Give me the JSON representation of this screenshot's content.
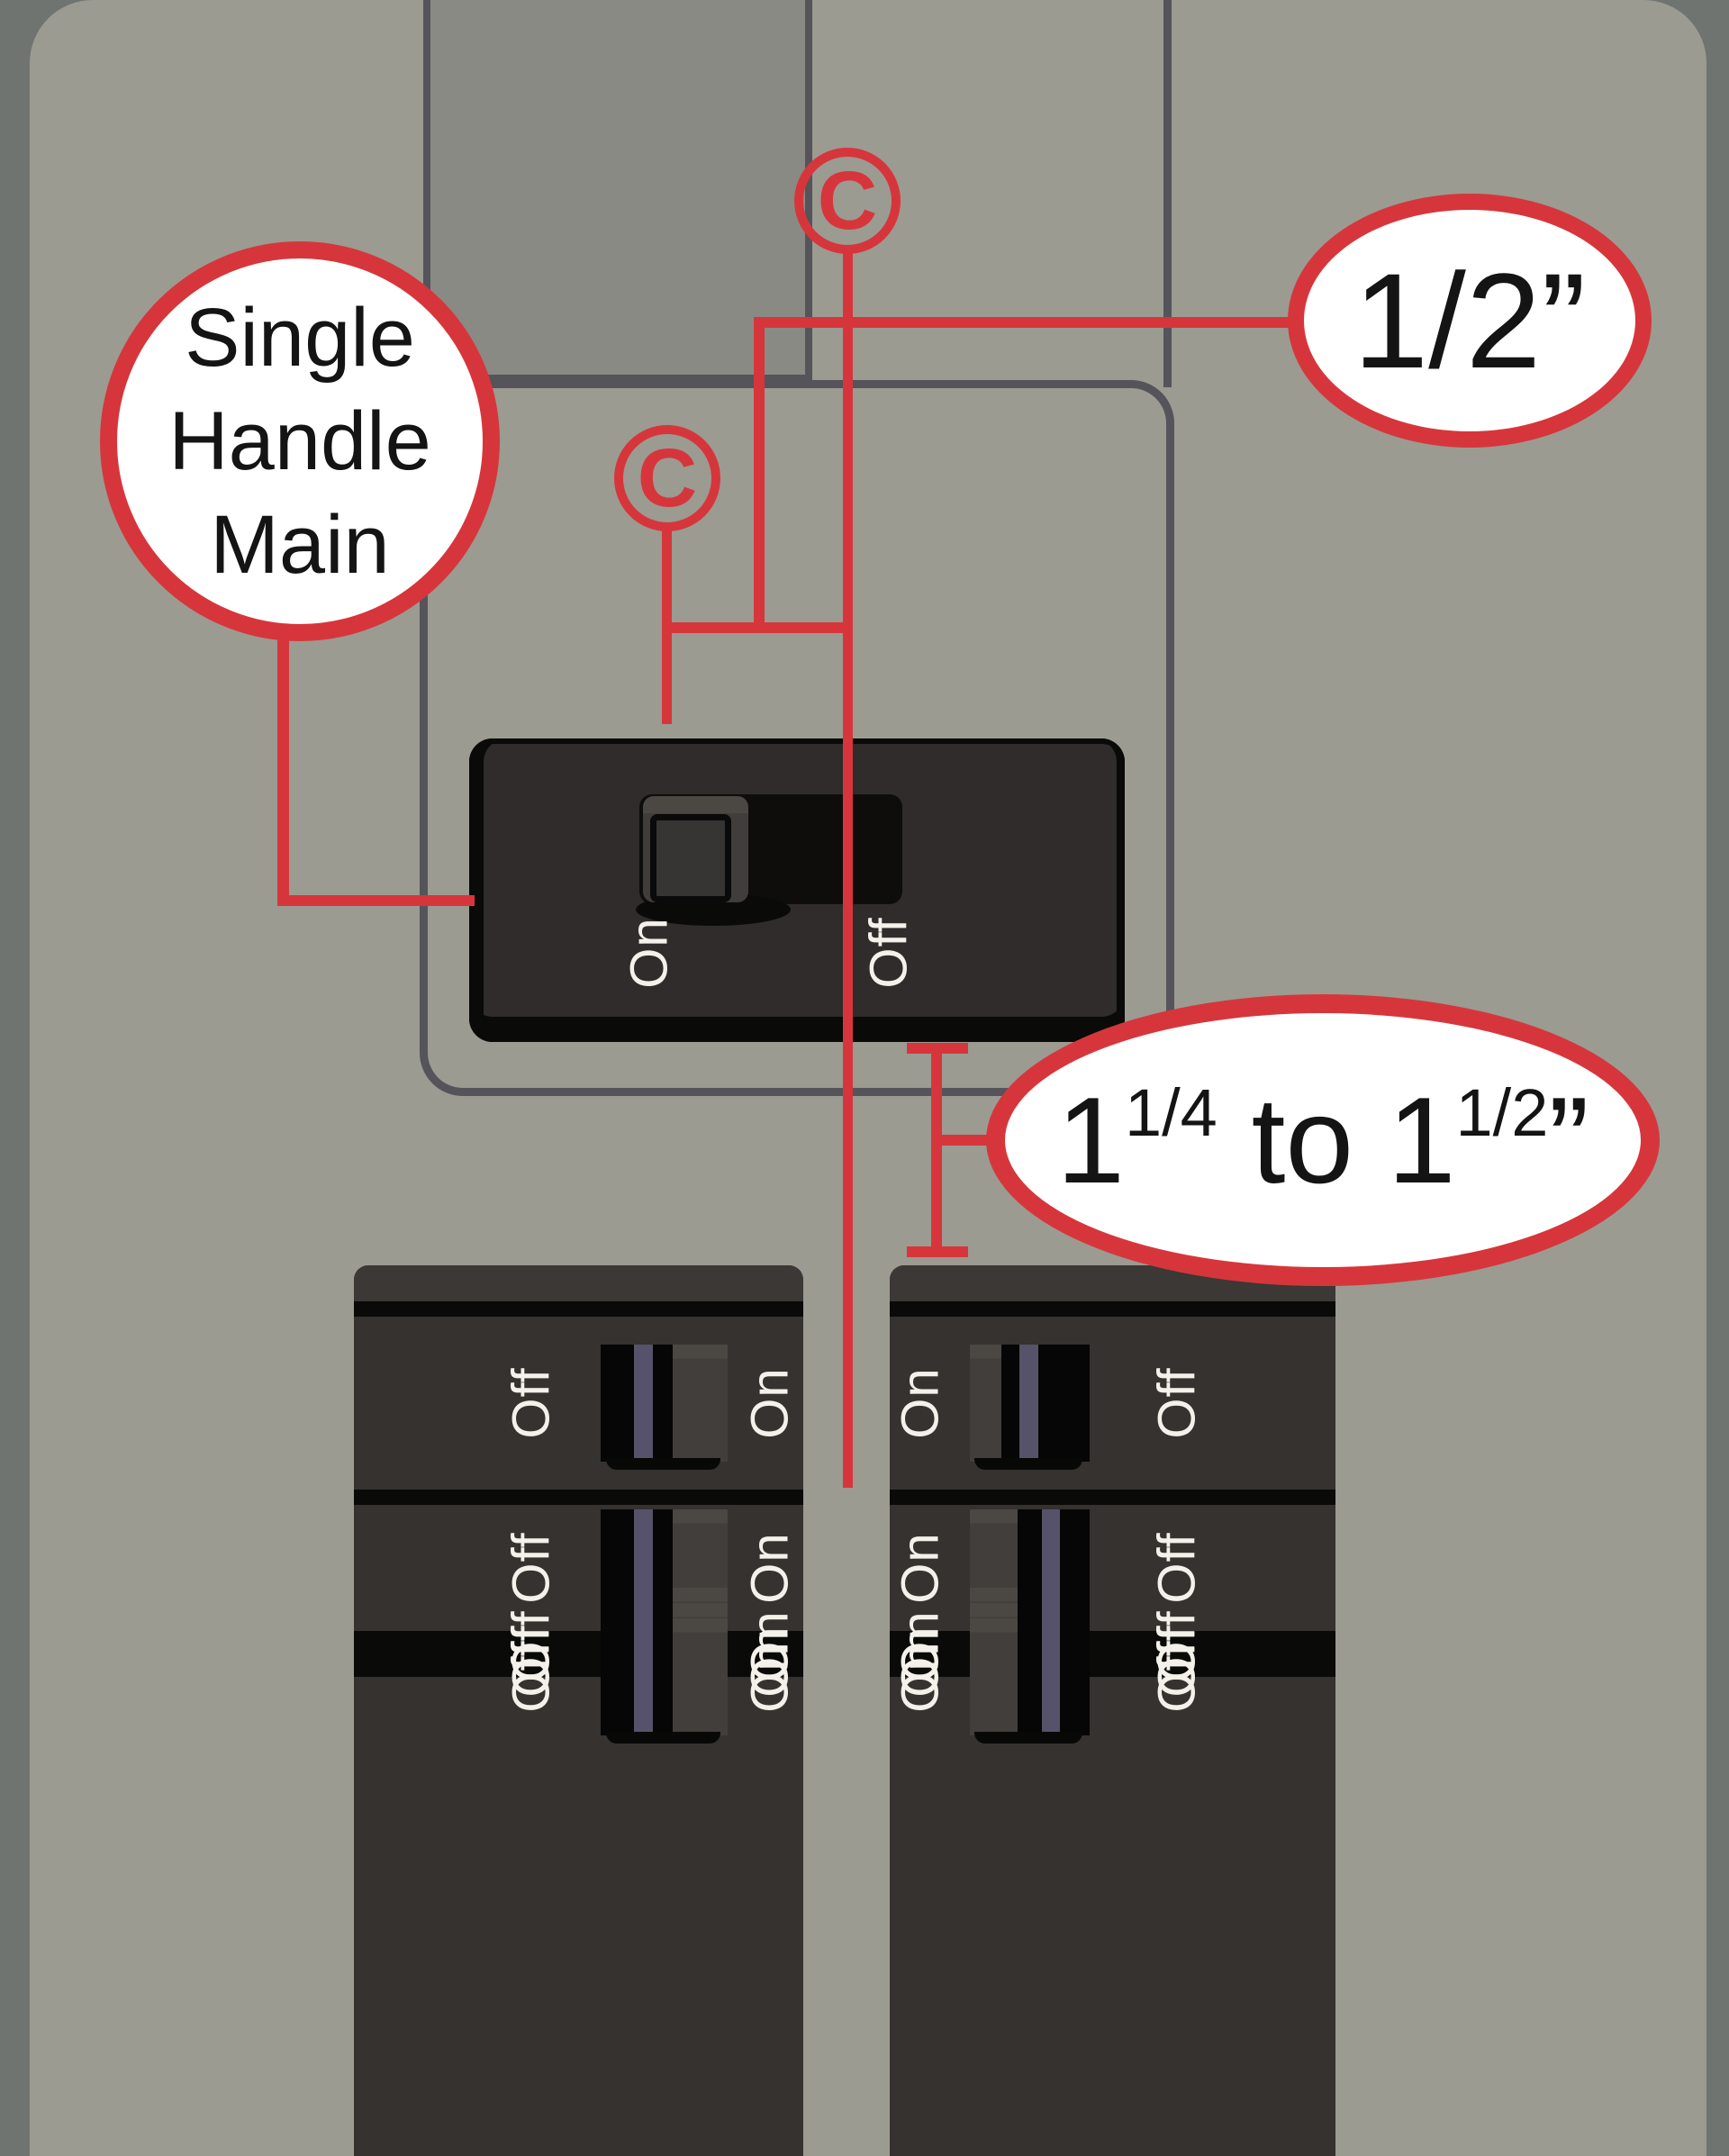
{
  "diagram_title": "electrical-panel-main-breaker-clearance-diagram",
  "colors": {
    "background": "#6f7471",
    "panel": "#9b9b92",
    "opening": "#8a8a84",
    "seam": "#54545a",
    "breaker_body": "#2f2c2b",
    "column_body": "#35322f",
    "toggle_blue": "#55526a",
    "toggle_gray": "#413e3b",
    "annotation_red": "#d6363b",
    "label_white": "#f3f1ea"
  },
  "callout": {
    "line1": "Single",
    "line2": "Handle",
    "line3": "Main"
  },
  "measurements": {
    "half_inch": "1/2”",
    "gap_range": {
      "n1": "1",
      "frac1": "1/4",
      "mid": " to 1",
      "frac2": "1/2",
      "ditto": "”"
    }
  },
  "centerline": {
    "symbol_top": "C",
    "symbol_mid": "C"
  },
  "panel": {
    "main_breaker": {
      "on_label": "On",
      "off_label": "Off"
    },
    "left_column": {
      "rows": [
        {
          "left_label": "Off",
          "right_label": "On"
        },
        {
          "left_label": "Off",
          "right_label": "On"
        },
        {
          "left_label": "Off",
          "right_label": "On"
        },
        {
          "left_label": "Off",
          "right_label": "On"
        },
        {
          "left_label": "Off",
          "right_label": "On"
        }
      ]
    },
    "right_column": {
      "rows": [
        {
          "left_label": "On",
          "right_label": "Off"
        },
        {
          "left_label": "On",
          "right_label": "Off"
        },
        {
          "left_label": "On",
          "right_label": "Off"
        },
        {
          "left_label": "On",
          "right_label": "Off"
        },
        {
          "left_label": "On",
          "right_label": "Off"
        }
      ]
    }
  }
}
